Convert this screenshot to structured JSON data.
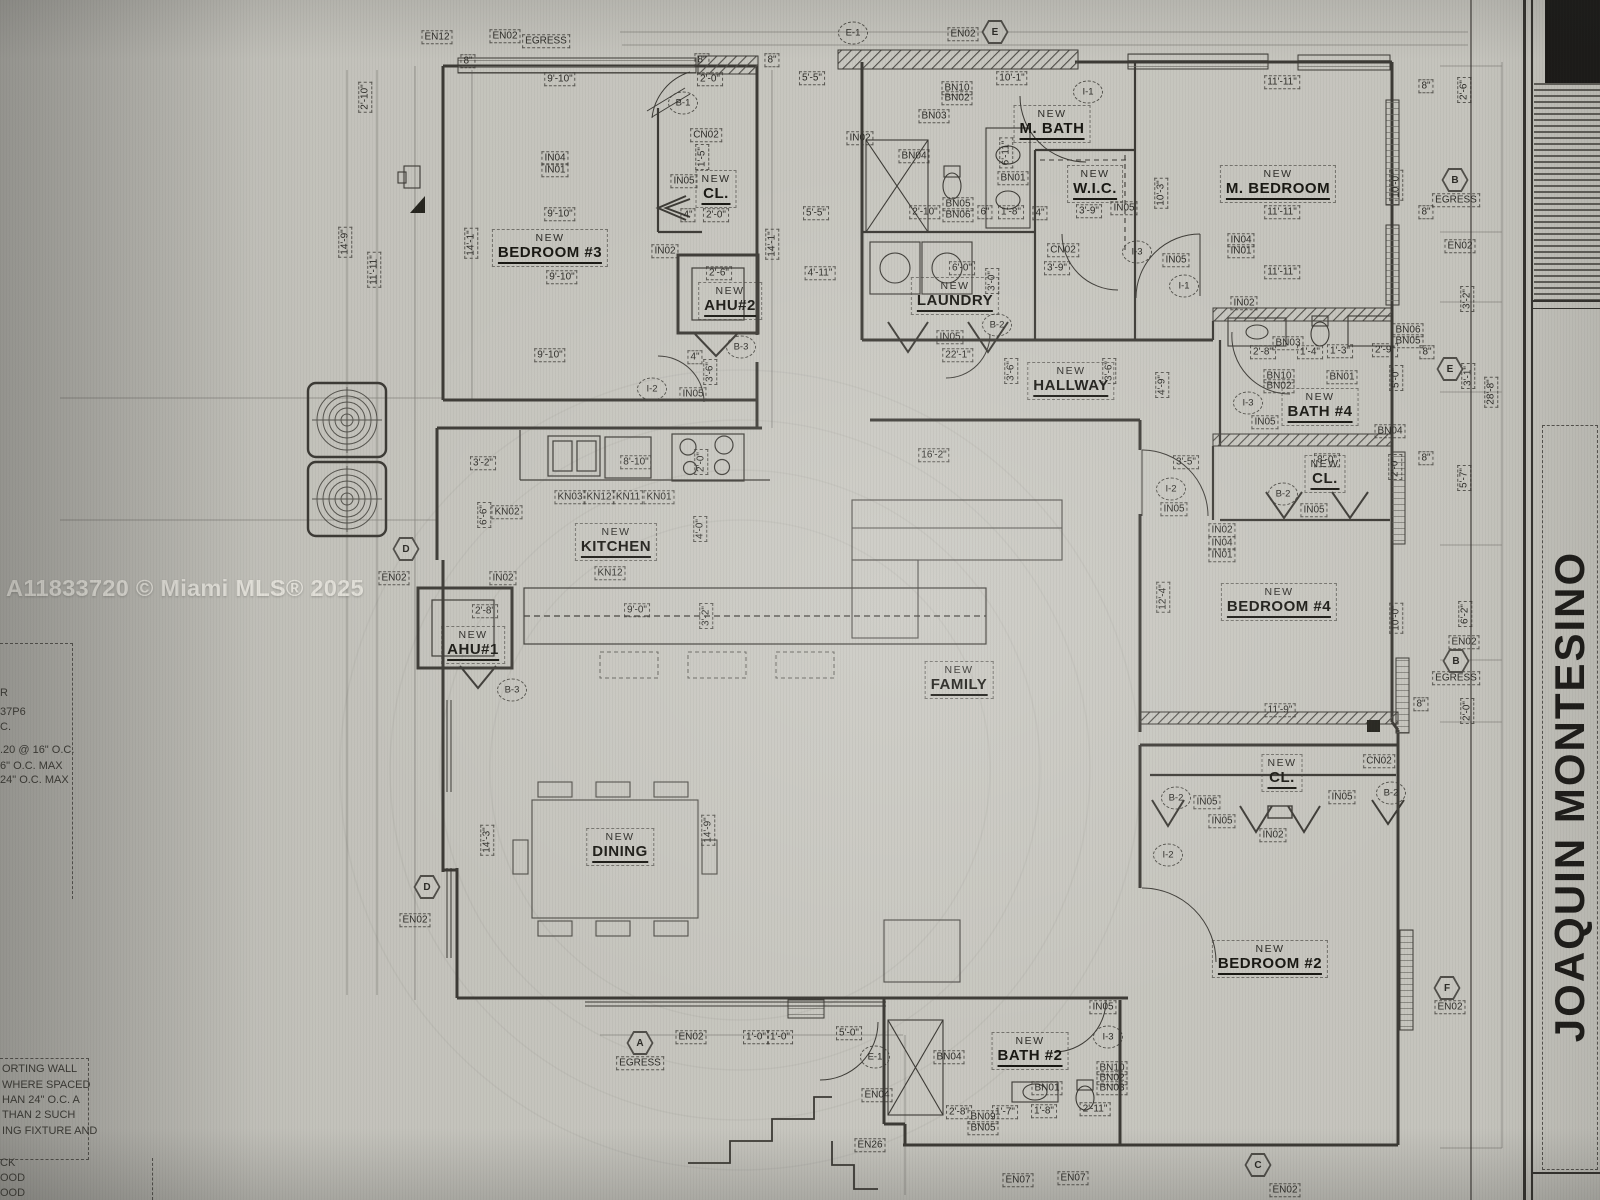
{
  "watermark": "A11833720 © Miami MLS® 2025",
  "title_block": {
    "name": "JOAQUIN MONTESINO"
  },
  "colors": {
    "paper": "#c8c7c0",
    "line": "#3c3a35",
    "dark_corner": "#1b1a18",
    "watermark_text": "#e6e4dd"
  },
  "side_notes": {
    "mid_fragments": [
      {
        "t": "R",
        "x": 0,
        "y": 694
      },
      {
        "t": "37P6",
        "x": 0,
        "y": 713
      },
      {
        "t": "C.",
        "x": 0,
        "y": 728
      },
      {
        "t": ".20 @ 16\" O.C.",
        "x": 0,
        "y": 751
      },
      {
        "t": "6\" O.C. MAX",
        "x": 0,
        "y": 767
      },
      {
        "t": "24\" O.C. MAX",
        "x": 0,
        "y": 781
      }
    ],
    "note_box_lines": [
      {
        "t": "ORTING WALL",
        "x": 2,
        "y": 1070
      },
      {
        "t": "WHERE SPACED",
        "x": 2,
        "y": 1086
      },
      {
        "t": "HAN 24\" O.C. A",
        "x": 2,
        "y": 1101
      },
      {
        "t": "THAN 2 SUCH",
        "x": 2,
        "y": 1116
      },
      {
        "t": "ING FIXTURE AND",
        "x": 2,
        "y": 1132
      }
    ],
    "bottom_fragments": [
      {
        "t": "CK",
        "x": 0,
        "y": 1164
      },
      {
        "t": "OOD",
        "x": 0,
        "y": 1179
      },
      {
        "t": "OOD",
        "x": 0,
        "y": 1194
      }
    ]
  },
  "plan": {
    "rooms": [
      {
        "pre": "NEW",
        "name": "BEDROOM #3",
        "x": 550,
        "y": 248
      },
      {
        "pre": "NEW",
        "name": "CL.",
        "x": 716,
        "y": 189
      },
      {
        "pre": "NEW",
        "name": "AHU#2",
        "x": 730,
        "y": 301
      },
      {
        "pre": "NEW",
        "name": "M. BATH",
        "x": 1052,
        "y": 124
      },
      {
        "pre": "NEW",
        "name": "W.I.C.",
        "x": 1095,
        "y": 184
      },
      {
        "pre": "NEW",
        "name": "LAUNDRY",
        "x": 955,
        "y": 296
      },
      {
        "pre": "NEW",
        "name": "M. BEDROOM",
        "x": 1278,
        "y": 184
      },
      {
        "pre": "NEW",
        "name": "HALLWAY",
        "x": 1071,
        "y": 381
      },
      {
        "pre": "NEW",
        "name": "BATH #4",
        "x": 1320,
        "y": 407
      },
      {
        "pre": "NEW",
        "name": "CL.",
        "x": 1325,
        "y": 474
      },
      {
        "pre": "NEW",
        "name": "KITCHEN",
        "x": 616,
        "y": 542
      },
      {
        "pre": "NEW",
        "name": "AHU#1",
        "x": 473,
        "y": 645
      },
      {
        "pre": "NEW",
        "name": "FAMILY",
        "x": 959,
        "y": 680
      },
      {
        "pre": "NEW",
        "name": "BEDROOM  #4",
        "x": 1279,
        "y": 602
      },
      {
        "pre": "NEW",
        "name": "DINING",
        "x": 620,
        "y": 847
      },
      {
        "pre": "NEW",
        "name": "CL.",
        "x": 1282,
        "y": 773
      },
      {
        "pre": "NEW",
        "name": "BEDROOM  #2",
        "x": 1270,
        "y": 959
      },
      {
        "pre": "NEW",
        "name": "BATH #2",
        "x": 1030,
        "y": 1051
      }
    ],
    "boxes": [
      {
        "t": "EN12",
        "x": 437,
        "y": 37
      },
      {
        "t": "EN02",
        "x": 505,
        "y": 36
      },
      {
        "t": "EGRESS",
        "x": 546,
        "y": 41
      },
      {
        "t": "EN02",
        "x": 963,
        "y": 34
      },
      {
        "t": "8\"",
        "x": 468,
        "y": 61
      },
      {
        "t": "8\"",
        "x": 702,
        "y": 60
      },
      {
        "t": "8\"",
        "x": 772,
        "y": 60
      },
      {
        "t": "9'-10\"",
        "x": 560,
        "y": 79
      },
      {
        "t": "2'-0\"",
        "x": 710,
        "y": 79
      },
      {
        "t": "5'-5\"",
        "x": 812,
        "y": 78
      },
      {
        "t": "10'-1\"",
        "x": 1012,
        "y": 78
      },
      {
        "t": "11'-11\"",
        "x": 1282,
        "y": 82
      },
      {
        "t": "8\"",
        "x": 1426,
        "y": 86
      },
      {
        "t": "2'-10\"",
        "x": 365,
        "y": 97,
        "r": 90
      },
      {
        "t": "2'-6\"",
        "x": 1464,
        "y": 90,
        "r": 90
      },
      {
        "t": "CN02",
        "x": 706,
        "y": 135
      },
      {
        "t": "IN04",
        "x": 555,
        "y": 158
      },
      {
        "t": "IN01",
        "x": 555,
        "y": 170
      },
      {
        "t": "IN05",
        "x": 684,
        "y": 181
      },
      {
        "t": "1'-5\"",
        "x": 702,
        "y": 157,
        "r": 90
      },
      {
        "t": "BN10",
        "x": 957,
        "y": 88
      },
      {
        "t": "BN02",
        "x": 957,
        "y": 98
      },
      {
        "t": "BN03",
        "x": 934,
        "y": 116
      },
      {
        "t": "IN02",
        "x": 860,
        "y": 138
      },
      {
        "t": "BN04",
        "x": 914,
        "y": 156
      },
      {
        "t": "6'-11\"",
        "x": 1006,
        "y": 153,
        "r": 90
      },
      {
        "t": "BN01",
        "x": 1013,
        "y": 178
      },
      {
        "t": "10'-3\"",
        "x": 1161,
        "y": 193,
        "r": 90
      },
      {
        "t": "10'-0\"",
        "x": 1396,
        "y": 185,
        "r": 90
      },
      {
        "t": "EGRESS",
        "x": 1456,
        "y": 200
      },
      {
        "t": "9'-10\"",
        "x": 560,
        "y": 214
      },
      {
        "t": "4\"",
        "x": 688,
        "y": 215
      },
      {
        "t": "2'-0\"",
        "x": 716,
        "y": 215
      },
      {
        "t": "5'-5\"",
        "x": 816,
        "y": 213
      },
      {
        "t": "2'-10\"",
        "x": 925,
        "y": 212
      },
      {
        "t": "BN05",
        "x": 958,
        "y": 204
      },
      {
        "t": "BN06",
        "x": 958,
        "y": 215
      },
      {
        "t": "6\"",
        "x": 985,
        "y": 212
      },
      {
        "t": "1'-8\"",
        "x": 1011,
        "y": 212
      },
      {
        "t": "4\"",
        "x": 1040,
        "y": 213
      },
      {
        "t": "3'-9\"",
        "x": 1089,
        "y": 211
      },
      {
        "t": "IN05",
        "x": 1124,
        "y": 208
      },
      {
        "t": "CN02",
        "x": 1063,
        "y": 250
      },
      {
        "t": "3'-9\"",
        "x": 1057,
        "y": 268
      },
      {
        "t": "IN05",
        "x": 1176,
        "y": 260
      },
      {
        "t": "IN04",
        "x": 1241,
        "y": 240
      },
      {
        "t": "IN01",
        "x": 1241,
        "y": 251
      },
      {
        "t": "11'-11\"",
        "x": 1282,
        "y": 212
      },
      {
        "t": "EN02",
        "x": 1460,
        "y": 246
      },
      {
        "t": "14'-9\"",
        "x": 345,
        "y": 242,
        "r": 90
      },
      {
        "t": "11'-11\"",
        "x": 374,
        "y": 270,
        "r": 90
      },
      {
        "t": "14'-1\"",
        "x": 471,
        "y": 243,
        "r": 90
      },
      {
        "t": "14'-1\"",
        "x": 772,
        "y": 244,
        "r": 90
      },
      {
        "t": "IN02",
        "x": 665,
        "y": 251
      },
      {
        "t": "9'-10\"",
        "x": 562,
        "y": 277
      },
      {
        "t": "2'-6\"",
        "x": 719,
        "y": 273
      },
      {
        "t": "4'-11\"",
        "x": 820,
        "y": 273
      },
      {
        "t": "11'-11\"",
        "x": 1282,
        "y": 272
      },
      {
        "t": "3'-2\"",
        "x": 1467,
        "y": 299,
        "r": 90
      },
      {
        "t": "6'-0\"",
        "x": 962,
        "y": 268
      },
      {
        "t": "3'-0\"",
        "x": 992,
        "y": 281,
        "r": 90
      },
      {
        "t": "IN02",
        "x": 1244,
        "y": 303
      },
      {
        "t": "BN06",
        "x": 1408,
        "y": 330
      },
      {
        "t": "BN05",
        "x": 1408,
        "y": 341
      },
      {
        "t": "8\"",
        "x": 1426,
        "y": 212
      },
      {
        "t": "8\"",
        "x": 1427,
        "y": 352
      },
      {
        "t": "BN03",
        "x": 1288,
        "y": 343
      },
      {
        "t": "2'-8\"",
        "x": 1263,
        "y": 352
      },
      {
        "t": "1'-4\"",
        "x": 1310,
        "y": 352
      },
      {
        "t": "1'-3\"",
        "x": 1340,
        "y": 351
      },
      {
        "t": "2'-9\"",
        "x": 1385,
        "y": 350
      },
      {
        "t": "9'-10\"",
        "x": 550,
        "y": 355
      },
      {
        "t": "IN05",
        "x": 950,
        "y": 337
      },
      {
        "t": "22'-1\"",
        "x": 958,
        "y": 355
      },
      {
        "t": "BN10",
        "x": 1279,
        "y": 376
      },
      {
        "t": "BN02",
        "x": 1279,
        "y": 386
      },
      {
        "t": "BN01",
        "x": 1342,
        "y": 377
      },
      {
        "t": "5'-0\"",
        "x": 1396,
        "y": 378,
        "r": 90
      },
      {
        "t": "3'-1\"",
        "x": 1468,
        "y": 376,
        "r": 90
      },
      {
        "t": "28'-8\"",
        "x": 1491,
        "y": 392,
        "r": 90
      },
      {
        "t": "BN04",
        "x": 1390,
        "y": 431
      },
      {
        "t": "4'-9\"",
        "x": 1162,
        "y": 385,
        "r": 90
      },
      {
        "t": "3'-6\"",
        "x": 710,
        "y": 372,
        "r": 90
      },
      {
        "t": "3'-6\"",
        "x": 1011,
        "y": 371,
        "r": 90
      },
      {
        "t": "3'-6\"",
        "x": 1109,
        "y": 371,
        "r": 90
      },
      {
        "t": "4\"",
        "x": 695,
        "y": 357
      },
      {
        "t": "IN05",
        "x": 693,
        "y": 394
      },
      {
        "t": "IN05",
        "x": 1265,
        "y": 422
      },
      {
        "t": "3'-2\"",
        "x": 483,
        "y": 463
      },
      {
        "t": "8'-10\"",
        "x": 636,
        "y": 462
      },
      {
        "t": "2'-0\"",
        "x": 701,
        "y": 462,
        "r": 90
      },
      {
        "t": "16'-2\"",
        "x": 934,
        "y": 455
      },
      {
        "t": "3'-5\"",
        "x": 1186,
        "y": 462
      },
      {
        "t": "8'-0\"",
        "x": 1327,
        "y": 460
      },
      {
        "t": "2'-0\"",
        "x": 1395,
        "y": 467,
        "r": 90
      },
      {
        "t": "8\"",
        "x": 1426,
        "y": 458
      },
      {
        "t": "5'-7\"",
        "x": 1464,
        "y": 478,
        "r": 90
      },
      {
        "t": "KN03",
        "x": 570,
        "y": 497
      },
      {
        "t": "KN12",
        "x": 599,
        "y": 497
      },
      {
        "t": "KN11",
        "x": 628,
        "y": 497
      },
      {
        "t": "KN01",
        "x": 659,
        "y": 497
      },
      {
        "t": "6'-6\"",
        "x": 484,
        "y": 515,
        "r": 90
      },
      {
        "t": "KN02",
        "x": 507,
        "y": 512
      },
      {
        "t": "IN05",
        "x": 1174,
        "y": 509
      },
      {
        "t": "IN05",
        "x": 1314,
        "y": 510
      },
      {
        "t": "IN02",
        "x": 1222,
        "y": 530
      },
      {
        "t": "IN04",
        "x": 1222,
        "y": 543
      },
      {
        "t": "IN01",
        "x": 1222,
        "y": 555
      },
      {
        "t": "IN02",
        "x": 503,
        "y": 578
      },
      {
        "t": "KN12",
        "x": 610,
        "y": 573
      },
      {
        "t": "EN02",
        "x": 394,
        "y": 578
      },
      {
        "t": "4'-0\"",
        "x": 700,
        "y": 529,
        "r": 90
      },
      {
        "t": "2'-8\"",
        "x": 485,
        "y": 611
      },
      {
        "t": "9'-0\"",
        "x": 637,
        "y": 610
      },
      {
        "t": "3'-2\"",
        "x": 706,
        "y": 616,
        "r": 90
      },
      {
        "t": "12'-4\"",
        "x": 1163,
        "y": 597,
        "r": 90
      },
      {
        "t": "10'-0\"",
        "x": 1396,
        "y": 618,
        "r": 90
      },
      {
        "t": "6'-2\"",
        "x": 1465,
        "y": 614,
        "r": 90
      },
      {
        "t": "EN02",
        "x": 1464,
        "y": 642
      },
      {
        "t": "EGRESS",
        "x": 1456,
        "y": 678
      },
      {
        "t": "2'-0\"",
        "x": 1467,
        "y": 711,
        "r": 90
      },
      {
        "t": "8\"",
        "x": 1421,
        "y": 704
      },
      {
        "t": "11'-9\"",
        "x": 1280,
        "y": 710
      },
      {
        "t": "CN02",
        "x": 1379,
        "y": 761
      },
      {
        "t": "IN05",
        "x": 1207,
        "y": 802
      },
      {
        "t": "IN05",
        "x": 1342,
        "y": 797
      },
      {
        "t": "IN05",
        "x": 1222,
        "y": 821
      },
      {
        "t": "IN02",
        "x": 1273,
        "y": 835
      },
      {
        "t": "14'-3\"",
        "x": 487,
        "y": 840,
        "r": 90
      },
      {
        "t": "14'-9\"",
        "x": 708,
        "y": 830,
        "r": 90
      },
      {
        "t": "EN02",
        "x": 415,
        "y": 920
      },
      {
        "t": "EGRESS",
        "x": 640,
        "y": 1063
      },
      {
        "t": "EN02",
        "x": 691,
        "y": 1037
      },
      {
        "t": "1'-0\"",
        "x": 756,
        "y": 1037
      },
      {
        "t": "1'-0\"",
        "x": 780,
        "y": 1037
      },
      {
        "t": "5'-0\"",
        "x": 849,
        "y": 1033
      },
      {
        "t": "EN04",
        "x": 877,
        "y": 1095
      },
      {
        "t": "EN26",
        "x": 870,
        "y": 1145
      },
      {
        "t": "EN02",
        "x": 1450,
        "y": 1007
      },
      {
        "t": "IN05",
        "x": 1103,
        "y": 1007
      },
      {
        "t": "BN04",
        "x": 949,
        "y": 1057
      },
      {
        "t": "BN01",
        "x": 1047,
        "y": 1088
      },
      {
        "t": "BN10",
        "x": 1112,
        "y": 1068
      },
      {
        "t": "BN02",
        "x": 1112,
        "y": 1078
      },
      {
        "t": "BN03",
        "x": 1112,
        "y": 1088
      },
      {
        "t": "2'-8\"",
        "x": 959,
        "y": 1112
      },
      {
        "t": "BN09",
        "x": 983,
        "y": 1117
      },
      {
        "t": "BN05",
        "x": 983,
        "y": 1128
      },
      {
        "t": "1'-7\"",
        "x": 1005,
        "y": 1112
      },
      {
        "t": "1'-8\"",
        "x": 1044,
        "y": 1111
      },
      {
        "t": "2'-11\"",
        "x": 1095,
        "y": 1109
      },
      {
        "t": "EN07",
        "x": 1018,
        "y": 1180
      },
      {
        "t": "EN07",
        "x": 1073,
        "y": 1178
      },
      {
        "t": "EN02",
        "x": 1285,
        "y": 1190
      }
    ],
    "circles": [
      {
        "t": "E-1",
        "x": 853,
        "y": 33
      },
      {
        "t": "B-1",
        "x": 683,
        "y": 103
      },
      {
        "t": "I-1",
        "x": 1088,
        "y": 92
      },
      {
        "t": "I-3",
        "x": 1137,
        "y": 252
      },
      {
        "t": "I-1",
        "x": 1184,
        "y": 286
      },
      {
        "t": "B-2",
        "x": 997,
        "y": 325
      },
      {
        "t": "B-3",
        "x": 741,
        "y": 347
      },
      {
        "t": "I-2",
        "x": 652,
        "y": 389
      },
      {
        "t": "I-3",
        "x": 1248,
        "y": 403
      },
      {
        "t": "I-2",
        "x": 1171,
        "y": 489
      },
      {
        "t": "B-2",
        "x": 1283,
        "y": 494
      },
      {
        "t": "B-3",
        "x": 512,
        "y": 690
      },
      {
        "t": "B-2",
        "x": 1176,
        "y": 798
      },
      {
        "t": "B-2",
        "x": 1391,
        "y": 793
      },
      {
        "t": "I-2",
        "x": 1168,
        "y": 855
      },
      {
        "t": "E-1",
        "x": 875,
        "y": 1057
      },
      {
        "t": "I-3",
        "x": 1108,
        "y": 1037
      }
    ],
    "hexes": [
      {
        "t": "E",
        "x": 995,
        "y": 32
      },
      {
        "t": "B",
        "x": 1455,
        "y": 180
      },
      {
        "t": "E",
        "x": 1450,
        "y": 369
      },
      {
        "t": "D",
        "x": 406,
        "y": 549
      },
      {
        "t": "B",
        "x": 1456,
        "y": 661
      },
      {
        "t": "F",
        "x": 1447,
        "y": 988
      },
      {
        "t": "D",
        "x": 427,
        "y": 887
      },
      {
        "t": "A",
        "x": 640,
        "y": 1043
      },
      {
        "t": "C",
        "x": 1258,
        "y": 1165
      }
    ]
  }
}
